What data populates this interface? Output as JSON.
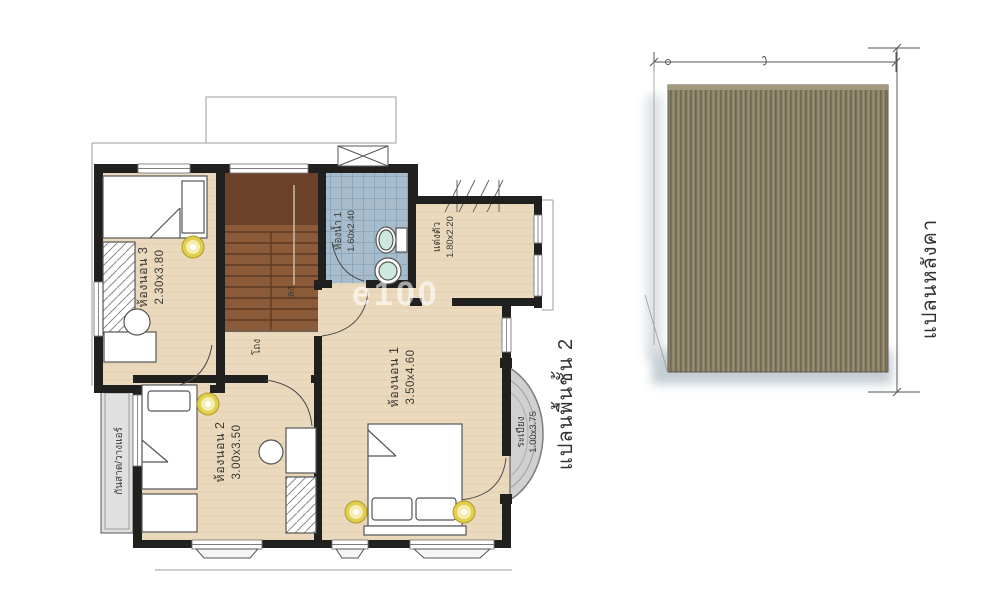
{
  "floor_plan": {
    "title": "แปลนพื้นชั้น 2",
    "rooms": {
      "bedroom3": {
        "name": "ห้องนอน 3",
        "size": "2.30x3.80"
      },
      "bathroom1": {
        "name": "ห้องน้ำ 1",
        "size": "1.60x2.40"
      },
      "dressing": {
        "name": "แต่งตัว",
        "size": "1.80x2.20"
      },
      "bedroom1": {
        "name": "ห้องนอน 1",
        "size": "3.50x4.60"
      },
      "bedroom2": {
        "name": "ห้องนอน 2",
        "size": "3.00x3.50"
      },
      "balcony": {
        "name": "ระเบียง",
        "size": "1.00x3.75"
      },
      "hall": {
        "name": "โถง"
      },
      "canopy": {
        "name": "กันสาด/วางแอร์"
      },
      "stairs": {
        "down_label": "ลง"
      }
    }
  },
  "roof_plan": {
    "title": "แปลนหลังคา"
  },
  "watermark": "e100",
  "colors": {
    "wall": "#20201e",
    "floor": "#ebd9bd",
    "bath_tile": "#a7bccd",
    "stair": "#8a5a39",
    "stair_landing": "#6b4129",
    "roof": "#8d8467",
    "lamp": "#e3cf4e",
    "balcony": "#d0d0d0"
  }
}
